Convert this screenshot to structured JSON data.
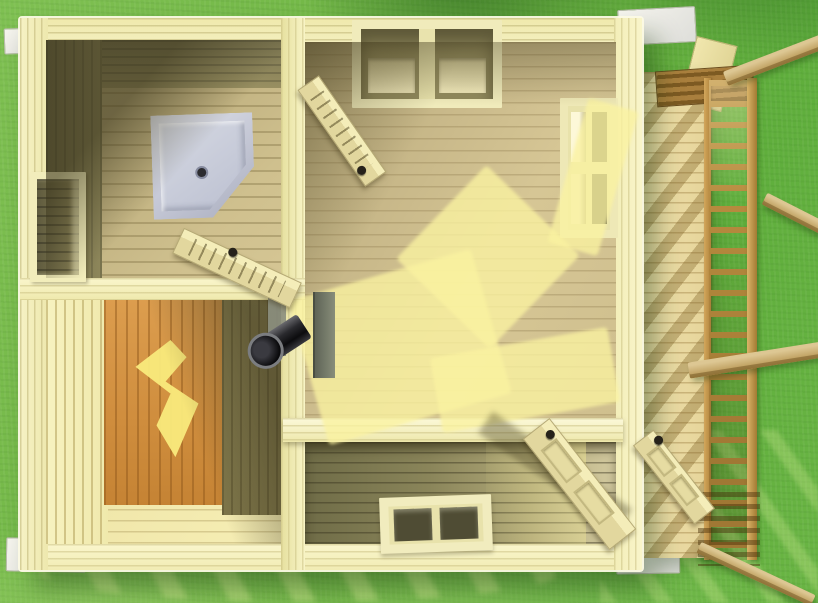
{
  "scene": {
    "title": "Wooden sauna cabin — top-down 3D floor-plan render",
    "view": "overhead cutaway without roof",
    "environment": "green lawn"
  },
  "labels": {
    "grass": "Lawn",
    "grass_streaks": "Sunlight streaks on lawn",
    "building": "Wooden cabin",
    "shower_room": "Shower room",
    "shower_tray": "Corner shower tray",
    "drain": "Shower drain",
    "left_window": "Left wall window opening",
    "sauna_room": "Sauna room",
    "sun_blob": "Sun spot on sauna wall",
    "stove_pipe": "Sauna stove chimney pipe",
    "heat_shield": "Heat shield plate",
    "main_room": "Main room",
    "top_window": "Top wall window",
    "right_window": "Right wall window",
    "hall": "Entrance hall",
    "bottom_window": "Bottom wall window",
    "door_shower": "Open door to shower room",
    "door_main": "Open door in main room",
    "door_hall": "Open interior door at entrance",
    "door_entrance": "Open entrance door to porch",
    "deck": "Porch deck",
    "railing": "Porch railing",
    "beam": "Pergola beam",
    "trim": "Corner trim block",
    "sun_patch": "Sunlight patch on floor"
  },
  "counts": {
    "rooms": 4,
    "windows": 4,
    "open_doors": 4,
    "pergola_beams": 4,
    "railing_rungs": 22
  },
  "colors": {
    "grass_light": "#7fc052",
    "grass_dark": "#5fae3c",
    "wall_cream": "#f2edb9",
    "wall_shadow_olive": "#6e6946",
    "floor_tan": "#cfbf8e",
    "floor_dark": "#6f6c47",
    "sun_yellow": "#faf2a0",
    "sauna_orange": "#d8994a",
    "shower_tray_gray": "#c6cad8",
    "pipe_black": "#0c0c0e",
    "deck_tan": "#ecdca4",
    "railing_brown": "#b68a3e",
    "trim_white": "#f3f2ea"
  }
}
